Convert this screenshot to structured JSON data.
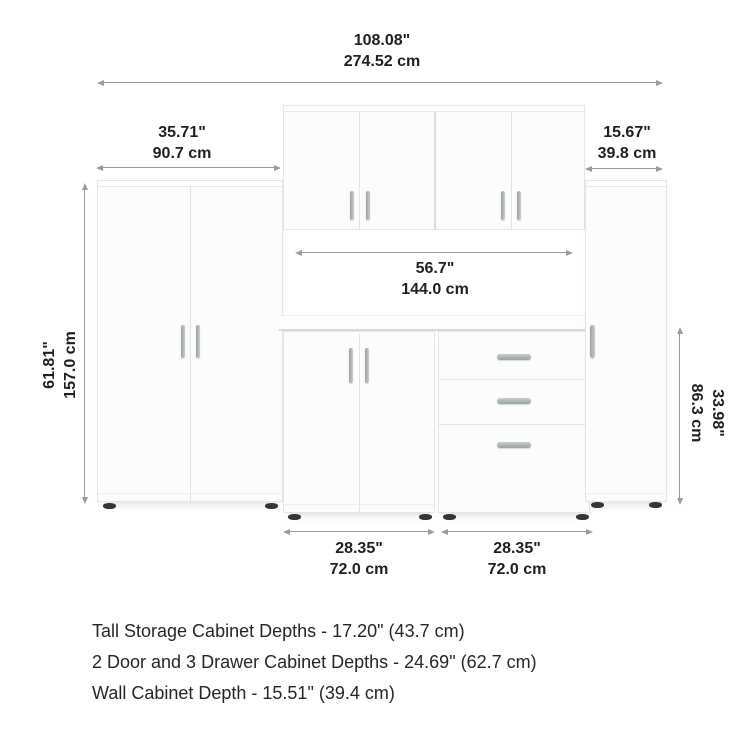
{
  "product": {
    "description": "6-piece modular storage set with two tall cabinets, wall cabinets, a 2-door base cabinet and a 3-drawer base cabinet"
  },
  "dims": {
    "total_width": {
      "in": "108.08\"",
      "cm": "274.52 cm"
    },
    "tall_cabinet_width": {
      "in": "35.71\"",
      "cm": "90.7 cm"
    },
    "right_cabinet_width": {
      "in": "15.67\"",
      "cm": "39.8 cm"
    },
    "opening_width": {
      "in": "56.7\"",
      "cm": "144.0 cm"
    },
    "tall_cabinet_height": {
      "in": "61.81\"",
      "cm": "157.0 cm"
    },
    "base_cabinet_height": {
      "in": "33.98\"",
      "cm": "86.3 cm"
    },
    "base_left_width": {
      "in": "28.35\"",
      "cm": "72.0 cm"
    },
    "base_right_width": {
      "in": "28.35\"",
      "cm": "72.0 cm"
    }
  },
  "notes": [
    "Tall Storage Cabinet Depths - 17.20\" (43.7 cm)",
    "2 Door and 3 Drawer Cabinet Depths - 24.69\" (62.7 cm)",
    "Wall Cabinet Depth - 15.51\" (39.4 cm)"
  ],
  "colors": {
    "background": "#ffffff",
    "dimension_line": "#9b9b9b",
    "text": "#1f1f1f",
    "cabinet_face": "#fcfcfc",
    "cabinet_edge": "#e5e5e5",
    "handle_silver": "#b0b5b8",
    "foot_dark": "#353535"
  }
}
